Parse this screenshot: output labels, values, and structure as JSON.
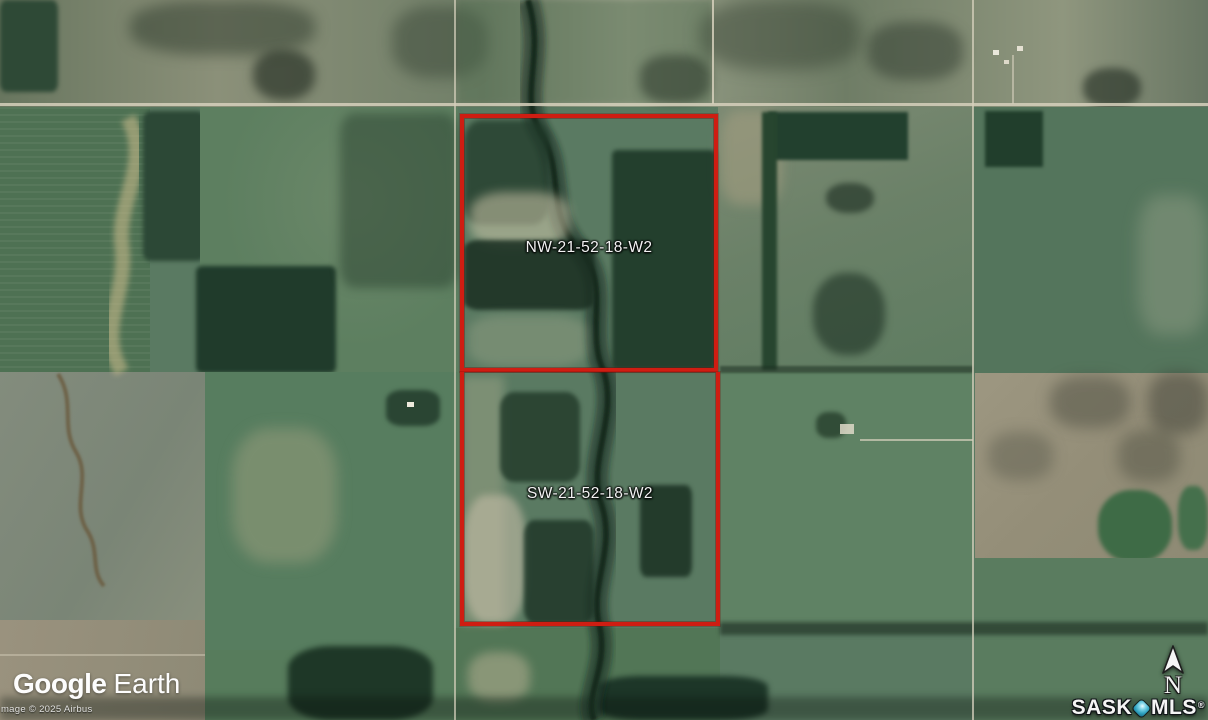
{
  "parcels": [
    {
      "label": "NW-21-52-18-W2"
    },
    {
      "label": "SW-21-52-18-W2"
    }
  ],
  "attribution": {
    "logo_word1": "Google",
    "logo_word2": "Earth",
    "copyright": "Image © 2025 Airbus"
  },
  "branding": {
    "name_prefix": "SASK",
    "name_suffix": "MLS",
    "registered_mark": "®",
    "diamond_icon": "location-diamond"
  },
  "compass": {
    "north_label": "N",
    "icon": "north-arrow"
  },
  "colors": {
    "parcel_outline": "#cf1d12",
    "mls_diamond": "#2fa3c0",
    "map_label_text": "#f2f2f2"
  }
}
